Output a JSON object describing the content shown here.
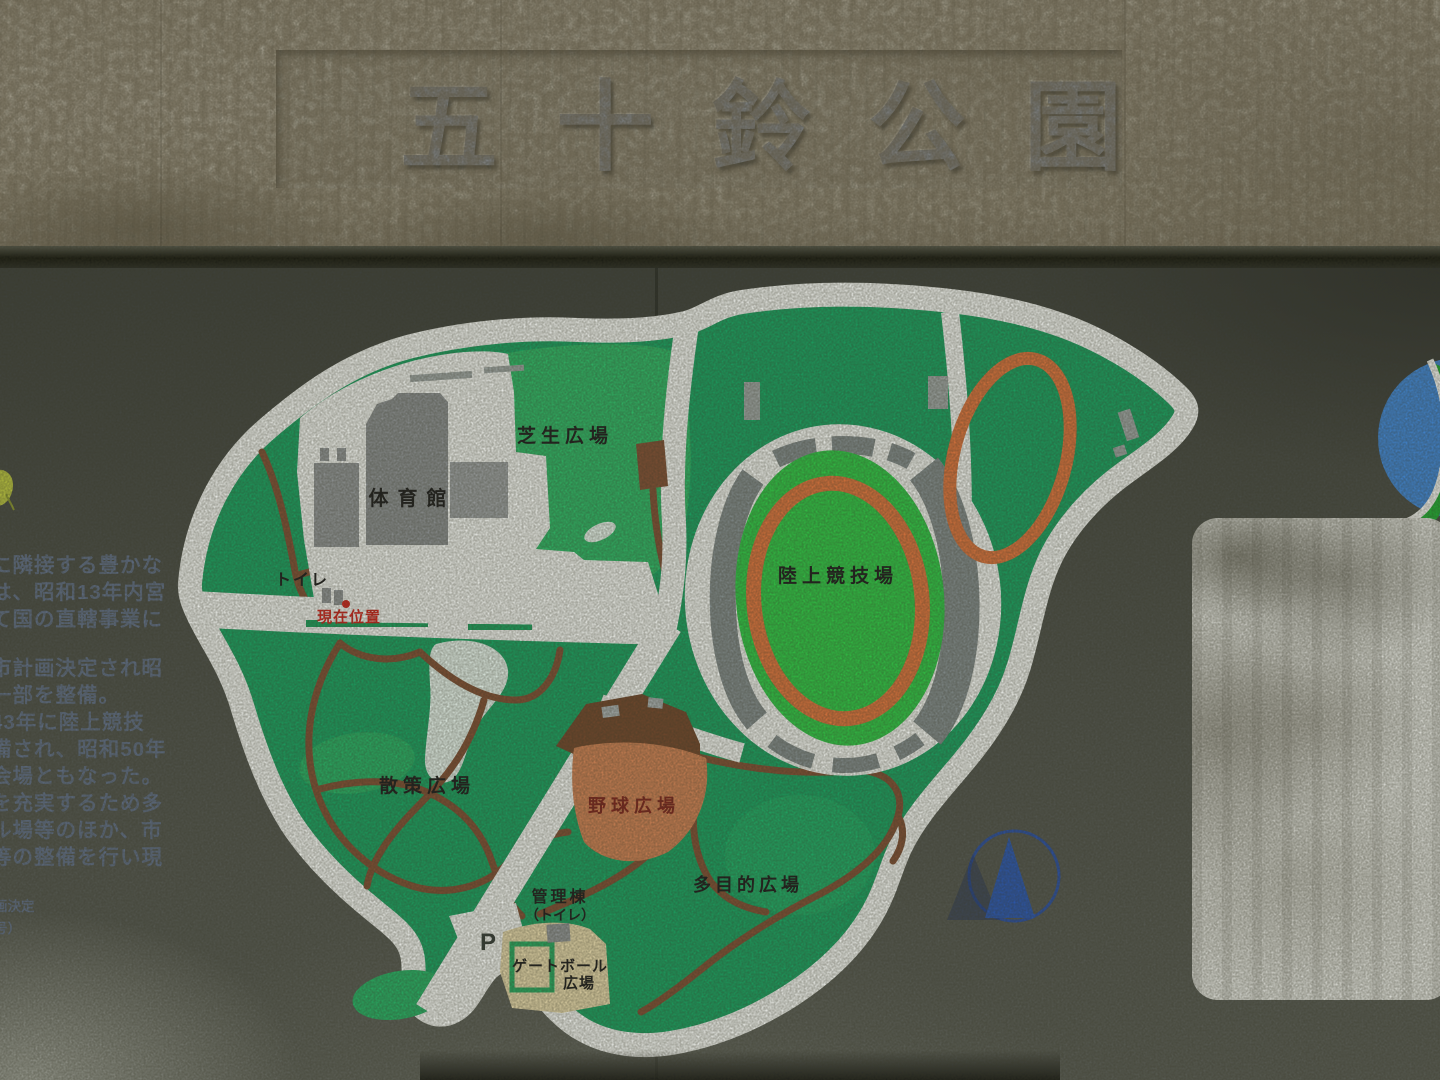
{
  "sign": {
    "title": "五十鈴公園"
  },
  "description_panel": {
    "lines": [
      "に隣接する豊かな",
      "は、昭和13年内宮",
      "て国の直轄事業に",
      "市計画決定され昭",
      "一部を整備。",
      "43年に陸上競技",
      "備され、昭和50年",
      "会場ともなった。",
      "を充実するため多",
      "ル場等のほか、市",
      "等の整備を行い現"
    ],
    "footnotes": [
      "画決定",
      "号）"
    ]
  },
  "map": {
    "labels": {
      "lawn_plaza": "芝生広場",
      "gymnasium": "体育館",
      "toilet": "トイレ",
      "current_location": "現在位置",
      "athletics_field": "陸上競技場",
      "strolling_plaza": "散策広場",
      "baseball_plaza": "野球広場",
      "multipurpose_plaza": "多目的広場",
      "management_building": "管理棟",
      "management_building_toilet": "（トイレ）",
      "parking": "P",
      "gateball_line1": "ゲートボール",
      "gateball_line2": "広場"
    },
    "colors": {
      "map_base_green": "#1a9c5e",
      "light_green": "#2eb163",
      "field_green": "#2fc044",
      "track_orange": "#d4713c",
      "baseball_clay": "#c87e52",
      "backstop_brown": "#6e462b",
      "path_brown": "#7d4e33",
      "road_white": "#e9ebe7",
      "building_gray": "#8d9192",
      "stands_gray": "#7e8787",
      "gateball_beige": "#ddd0a4",
      "marker_red": "#c8241c",
      "emblem_blue": "#2b55a8",
      "logo_blue": "#3f82cc",
      "logo_green": "#21a733"
    },
    "icons": {
      "current_location_marker": "red-dot",
      "city_emblem": "twin-mountains-in-circle",
      "corner_logo": "blue-green-swirl-ball"
    }
  }
}
